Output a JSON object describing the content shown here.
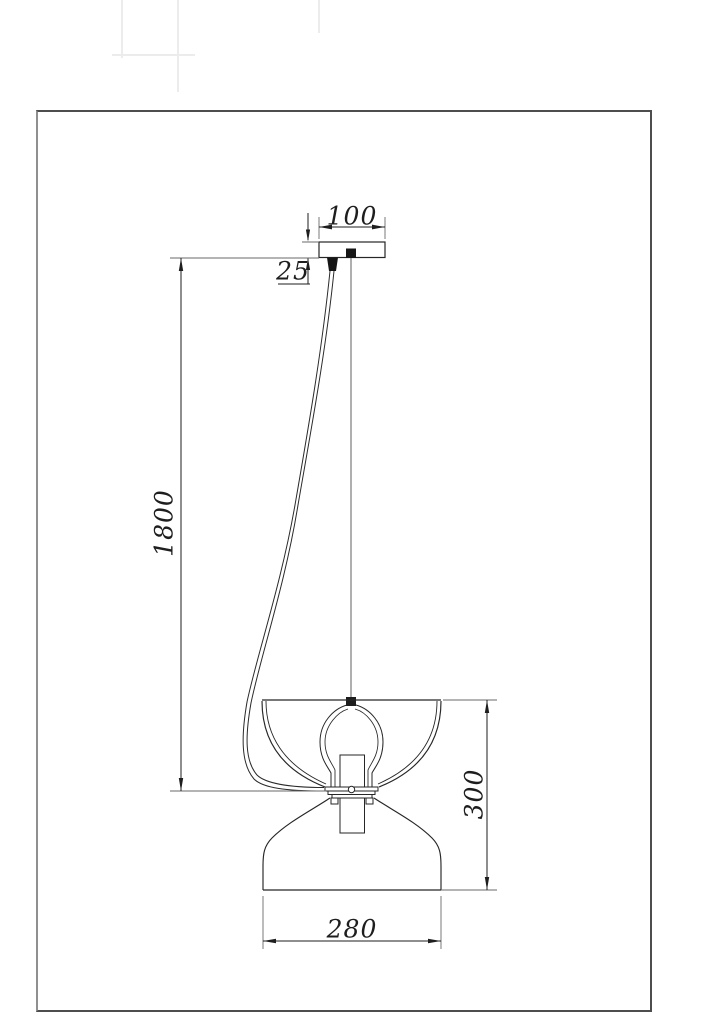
{
  "drawing": {
    "type": "technical-dimension-diagram",
    "subject": "pendant-lamp-installation-drawing",
    "dimensions": {
      "canopy_width": "100",
      "canopy_height": "25",
      "suspension_length": "1800",
      "shade_height": "300",
      "shade_width": "280"
    }
  }
}
